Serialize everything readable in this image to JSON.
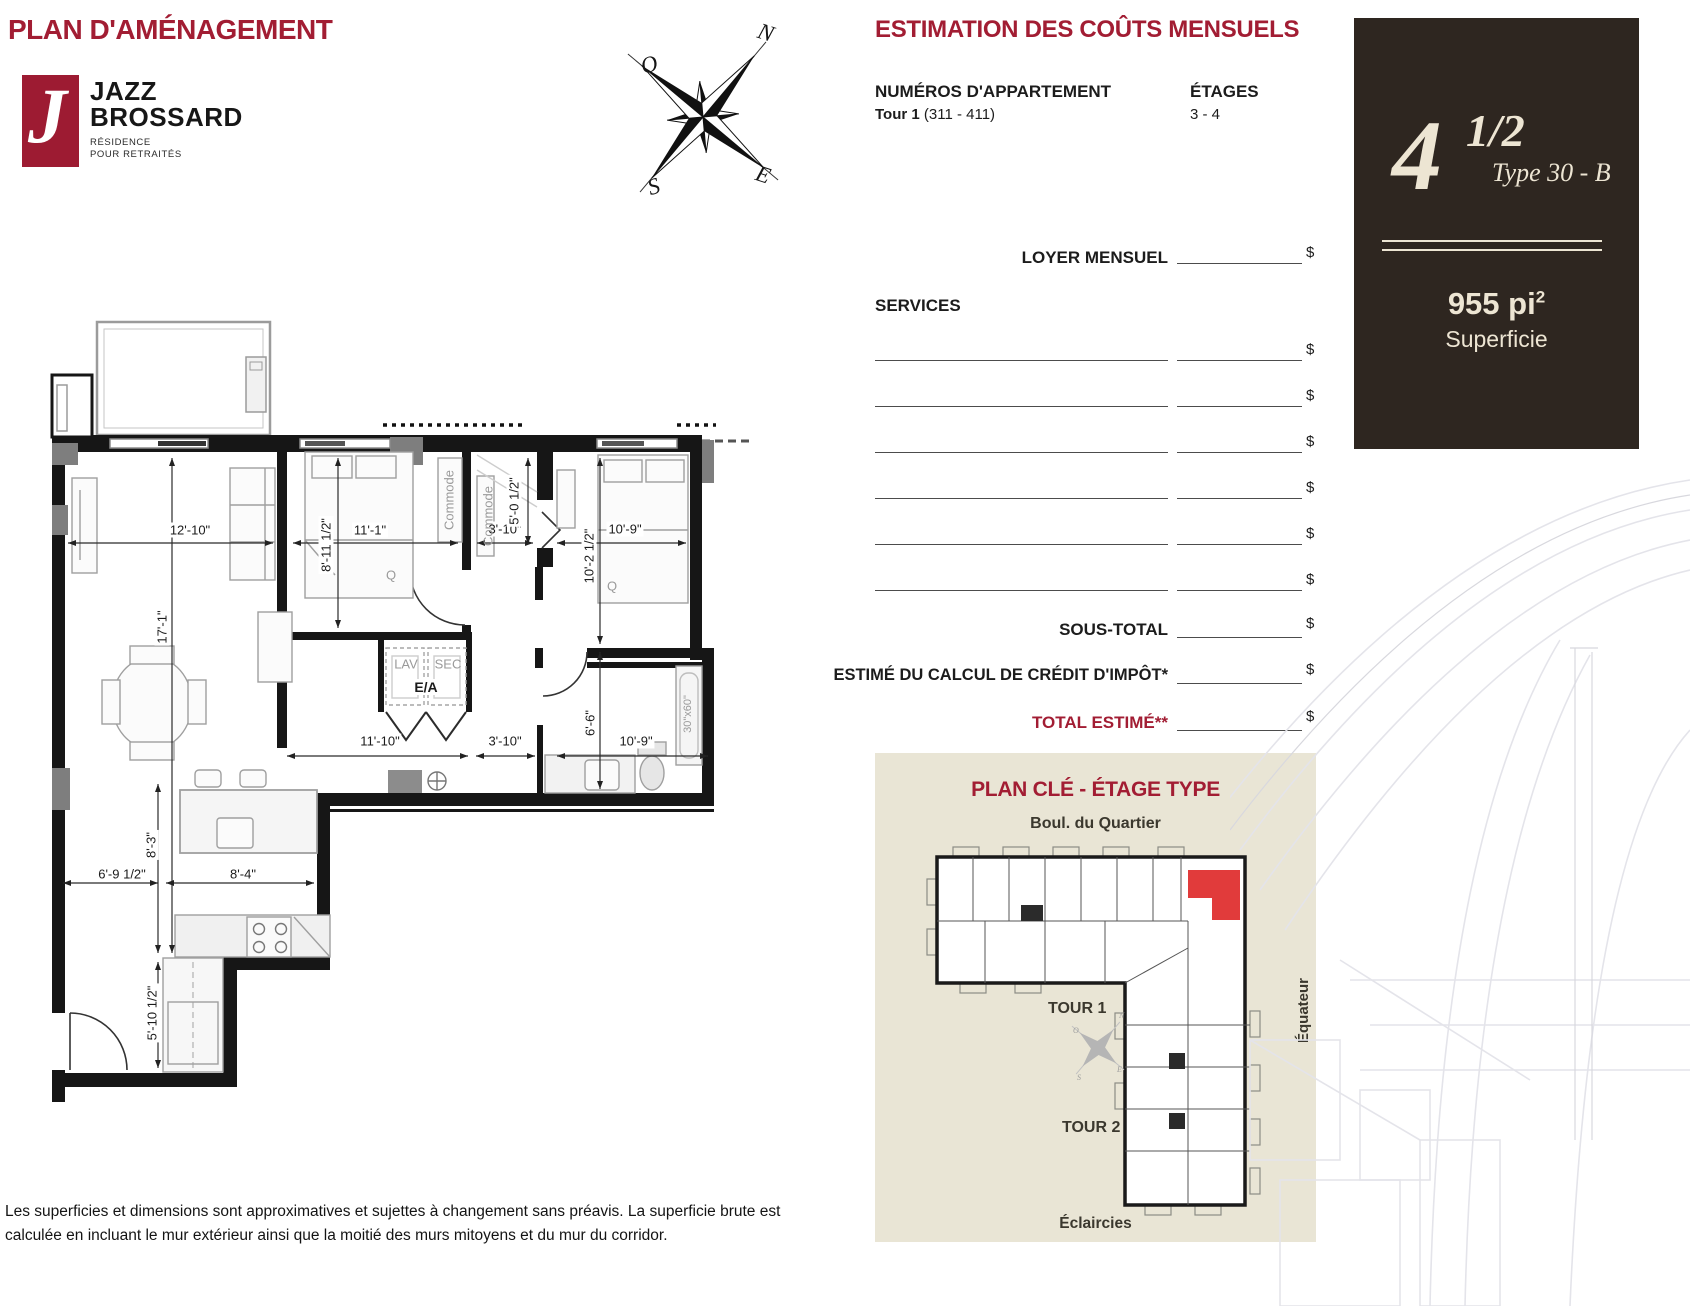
{
  "page": {
    "title": "PLAN D'AMÉNAGEMENT",
    "disclaimer_line1": "Les superficies et dimensions sont approximatives et sujettes à changement sans préavis. La superficie brute est",
    "disclaimer_line2": "calculée en incluant le mur extérieur ainsi que la moitié des murs mitoyens et du mur du corridor."
  },
  "logo": {
    "monogram": "J",
    "name_line1": "JAZZ",
    "name_line2": "BROSSARD",
    "subtitle_line1": "RÉSIDENCE",
    "subtitle_line2": "POUR RETRAITÉS"
  },
  "compass": {
    "n": "N",
    "o": "O",
    "e": "E",
    "s": "S"
  },
  "estimation": {
    "title": "ESTIMATION DES COÛTS MENSUELS",
    "apartment_numbers_label": "NUMÉROS D'APPARTEMENT",
    "tower_label": "Tour 1",
    "apartment_numbers": "(311 - 411)",
    "floors_label": "ÉTAGES",
    "floors": "3 - 4",
    "loyer_label": "LOYER MENSUEL",
    "services_label": "SERVICES",
    "sous_total_label": "SOUS-TOTAL",
    "credit_label": "ESTIMÉ DU CALCUL DE CRÉDIT D'IMPÔT*",
    "total_label": "TOTAL ESTIMÉ**",
    "currency": "$"
  },
  "unit_panel": {
    "size": "4",
    "fraction": "1/2",
    "type": "Type 30 - B",
    "area": "955 pi",
    "area_exponent": "2",
    "area_label": "Superficie"
  },
  "key_plan": {
    "title": "PLAN CLÉ - ÉTAGE TYPE",
    "street_top": "Boul. du Quartier",
    "tower1": "TOUR 1",
    "tower2": "TOUR 2",
    "street_right": "Équateur",
    "street_bottom": "Éclaircies"
  },
  "floorplan": {
    "labels": {
      "w_living": "12'-10\"",
      "w_bed1": "11'-1\"",
      "w_closet": "3'-10\"",
      "w_bed2": "10'-9\"",
      "h_bed1": "8'-11 1/2\"",
      "h_closet": "5'-0 1/2\"",
      "h_bed2": "10'-2 1/2\"",
      "h_living": "17'-1\"",
      "w_hall": "11'-10\"",
      "w_hall2": "3'-10\"",
      "h_bath": "6'-6\"",
      "w_bath": "10'-9\"",
      "h_kitchen": "8'-3\"",
      "w_entry": "6'-9 1/2\"",
      "w_kitchen": "8'-4\"",
      "h_entry": "5'-10 1/2\"",
      "commode1": "Commode",
      "commode2": "Commode",
      "lav": "LAV",
      "sec": "SEC",
      "ea": "E/A",
      "tub": "30\"x60\"",
      "q1": "Q",
      "q2": "Q"
    }
  },
  "colors": {
    "brand_red": "#A21D33",
    "panel_brown": "#2E2620",
    "panel_cream": "#EDE5D3",
    "keyplan_bg": "#E9E5D5",
    "highlight_red": "#E13B3B"
  }
}
